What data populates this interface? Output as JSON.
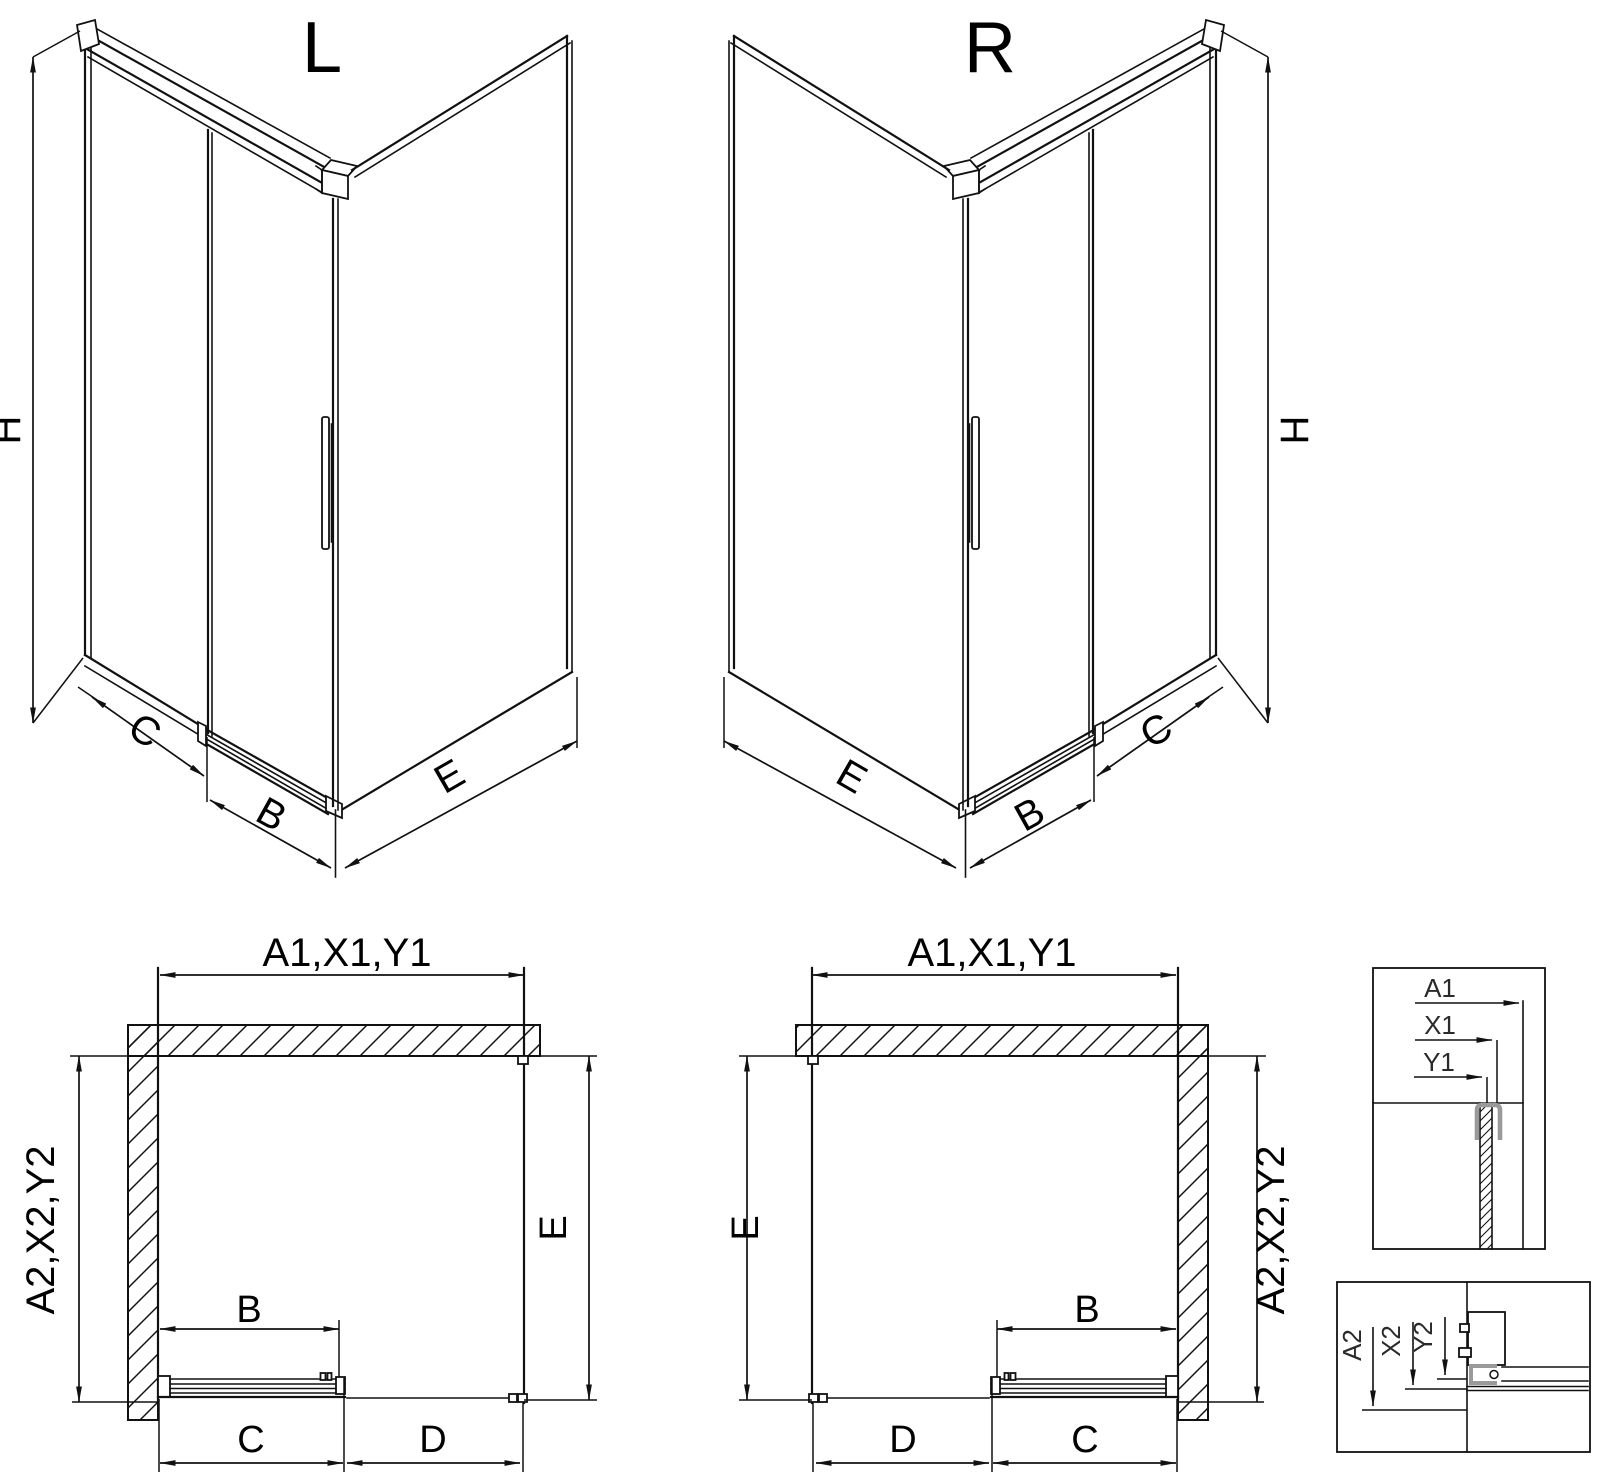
{
  "drawing": {
    "type": "shower-enclosure-technical-drawing",
    "variants": [
      "L",
      "R"
    ]
  },
  "views": {
    "iso_left": {
      "title": "L",
      "height": "H",
      "back_panel": "C",
      "door": "B",
      "side_panel": "E"
    },
    "iso_right": {
      "title": "R",
      "height": "H",
      "back_panel": "C",
      "door": "B",
      "side_panel": "E"
    },
    "plan_left": {
      "width_top": "A1,X1,Y1",
      "depth_side": "A2,X2,Y2",
      "side": "E",
      "door": "B",
      "bottom_first": "C",
      "bottom_second": "D"
    },
    "plan_right": {
      "width_top": "A1,X1,Y1",
      "depth_side": "A2,X2,Y2",
      "side": "E",
      "door": "B",
      "bottom_first": "D",
      "bottom_second": "C"
    },
    "detail_width": {
      "labels": [
        "A1",
        "X1",
        "Y1"
      ]
    },
    "detail_depth": {
      "labels": [
        "A2",
        "X2",
        "Y2"
      ]
    }
  },
  "colors": {
    "ink": "#111111",
    "profile_gray": "#9a9a9a",
    "paper": "#ffffff"
  }
}
